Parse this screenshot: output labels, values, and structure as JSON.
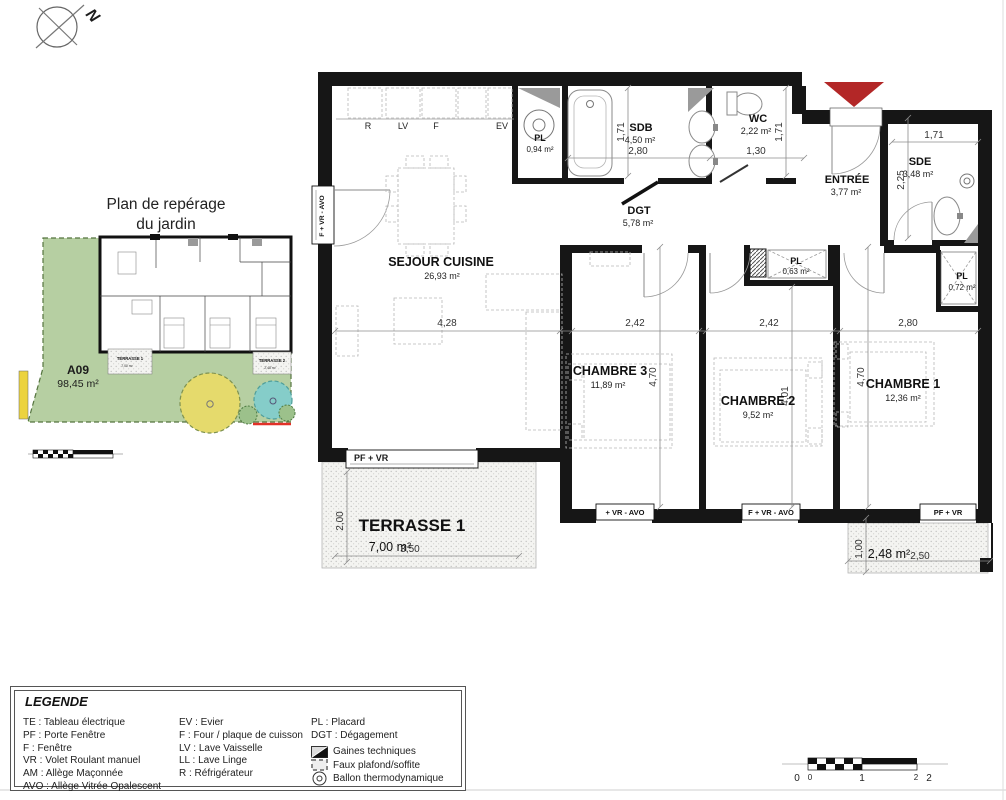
{
  "colors": {
    "garden_green": "#b6cfa2",
    "tree_yellow": "#e5da6c",
    "pool_teal": "#85cdc9",
    "accent_red": "#b32727",
    "red_line": "#e23128",
    "yellow_strip": "#ecd33f"
  },
  "compass": {
    "north": "N"
  },
  "mini_plan": {
    "title_line1": "Plan de repérage",
    "title_line2": "du jardin",
    "lot": "A09",
    "lot_area": "98,45 m²",
    "terrasse1": "TERRASSE 1",
    "terrasse1_area": "7,00 m²",
    "terrasse2": "TERRASSE 2",
    "terrasse2_area": "2,48 m²"
  },
  "rooms": {
    "sejour": {
      "name": "SEJOUR CUISINE",
      "area": "26,93 m²"
    },
    "pl_cuisine": {
      "name": "PL",
      "area": "0,94 m²"
    },
    "sdb": {
      "name": "SDB",
      "area": "4,50 m²"
    },
    "wc": {
      "name": "WC",
      "area": "2,22 m²"
    },
    "dgt": {
      "name": "DGT",
      "area": "5,78 m²"
    },
    "entree": {
      "name": "ENTRÉE",
      "area": "3,77 m²"
    },
    "sde": {
      "name": "SDE",
      "area": "3,48 m²"
    },
    "pl_ch1": {
      "name": "PL",
      "area": "0,72 m²"
    },
    "pl_ch2": {
      "name": "PL",
      "area": "0,63 m²"
    },
    "chambre1": {
      "name": "CHAMBRE 1",
      "area": "12,36 m²"
    },
    "chambre2": {
      "name": "CHAMBRE 2",
      "area": "9,52 m²"
    },
    "chambre3": {
      "name": "CHAMBRE 3",
      "area": "11,89 m²"
    },
    "terrasse1": {
      "name": "TERRASSE 1",
      "area": "7,00 m²"
    },
    "terrasse2": {
      "name": "TERRASSE 2",
      "area": "2,48 m²"
    }
  },
  "appliances": {
    "fridge": "R",
    "dishwasher": "LV",
    "oven": "F",
    "sink": "EV"
  },
  "windows": {
    "sejour_side": "F + VR - AVO",
    "terrasse1": "PF + VR",
    "chambre3": "+ VR - AVO",
    "chambre2": "F + VR - AVO",
    "chambre1": "PF + VR"
  },
  "dimensions": {
    "sejour_w": "4,28",
    "chambre3_w": "2,42",
    "chambre2_w": "2,42",
    "chambre1_w": "2,80",
    "sdb_w": "2,80",
    "wc_w": "1,30",
    "sdb_h": "1,71",
    "wc_h": "1,71",
    "sde_w": "1,71",
    "sde_h": "2,25",
    "chambre3_h": "4,70",
    "chambre2_h": "4,01",
    "chambre1_h": "4,70",
    "terrasse1_h": "2,00",
    "terrasse1_w": "3,50",
    "terrasse2_h": "1,00",
    "terrasse2_w": "2,50"
  },
  "legend": {
    "title": "LEGENDE",
    "col1": [
      "TE :  Tableau électrique",
      "PF :  Porte Fenêtre",
      "F :  Fenêtre",
      "VR : Volet Roulant manuel",
      "AM : Allège Maçonnée",
      "AVO :  Allège Vitrée Opalescent"
    ],
    "col2": [
      "EV :  Evier",
      "F :  Four / plaque de cuisson",
      "LV :  Lave Vaisselle",
      "LL :  Lave Linge",
      "R :  Réfrigérateur"
    ],
    "col3": [
      "PL :  Placard",
      "DGT : Dégagement"
    ],
    "symbols": [
      "Gaines techniques",
      "Faux plafond/soffite",
      "Ballon thermodynamique"
    ]
  },
  "scale_bar": {
    "labels": [
      "0",
      "0",
      "1",
      "2",
      "2"
    ]
  }
}
